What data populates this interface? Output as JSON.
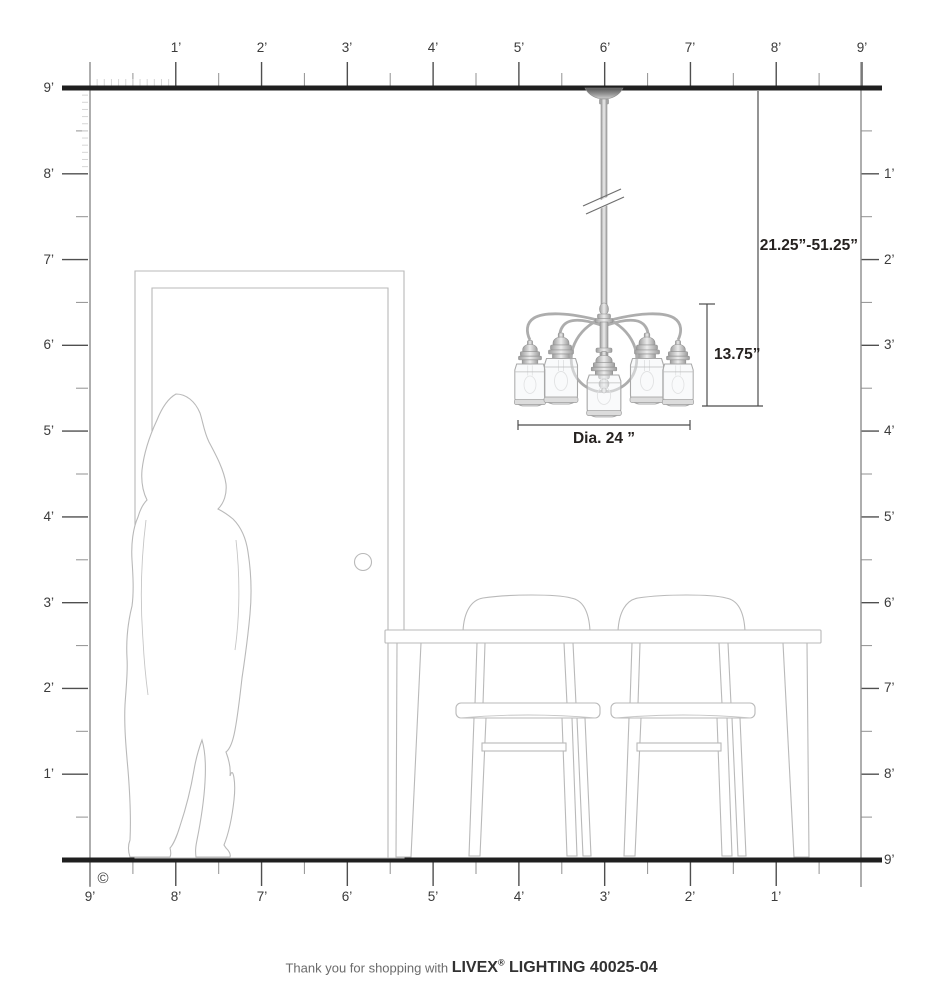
{
  "rulers": {
    "unit": "feet",
    "top": [
      "1’",
      "2’",
      "3’",
      "4’",
      "5’",
      "6’",
      "7’",
      "8’",
      "9’"
    ],
    "left": [
      "9’",
      "8’",
      "7’",
      "6’",
      "5’",
      "4’",
      "3’",
      "2’",
      "1’"
    ],
    "right": [
      "1’",
      "2’",
      "3’",
      "4’",
      "5’",
      "6’",
      "7’",
      "8’",
      "9’"
    ],
    "bottom": [
      "9’",
      "8’",
      "7’",
      "6’",
      "5’",
      "4’",
      "3’",
      "2’",
      "1’"
    ]
  },
  "dimensions": {
    "hanging_range": "21.25”-51.25”",
    "fixture_height": "13.75”",
    "diameter": "Dia. 24 ”"
  },
  "copyright": "©",
  "footer": {
    "prefix": "Thank you for shopping with",
    "brand": "LIVEX",
    "registered": "®",
    "rest": "LIGHTING 40025-04"
  },
  "colors": {
    "ceiling_floor_line": "#1f1f1f",
    "ruler_tick": "#4f4f4f",
    "furniture_outline": "#b9b9b9",
    "dimension_text": "#262220",
    "metal_gray": "#9d9d9d"
  }
}
